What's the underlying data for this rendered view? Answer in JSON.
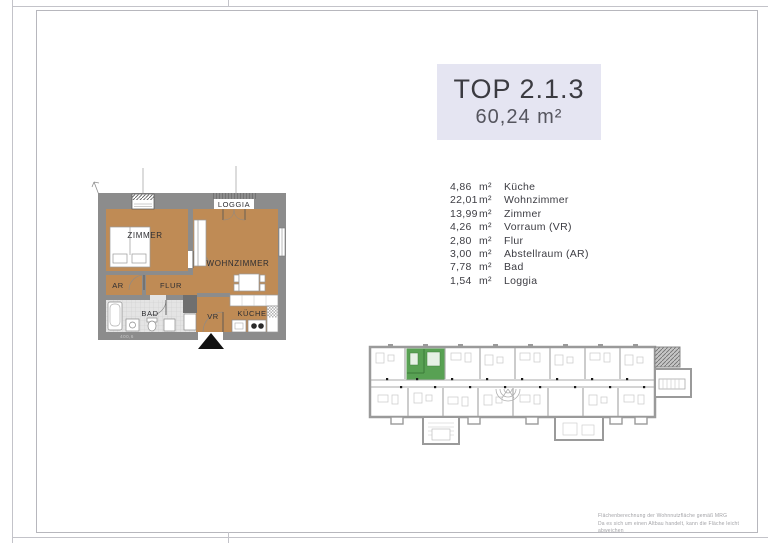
{
  "header": {
    "title": "TOP 2.1.3",
    "total_area": "60,24 m²"
  },
  "rooms": [
    {
      "area": "4,86",
      "unit": "m²",
      "name": "Küche"
    },
    {
      "area": "22,01",
      "unit": "m²",
      "name": "Wohnzimmer"
    },
    {
      "area": "13,99",
      "unit": "m²",
      "name": "Zimmer"
    },
    {
      "area": "4,26",
      "unit": "m²",
      "name": "Vorraum (VR)"
    },
    {
      "area": "2,80",
      "unit": "m²",
      "name": "Flur"
    },
    {
      "area": "3,00",
      "unit": "m²",
      "name": "Abstellraum (AR)"
    },
    {
      "area": "7,78",
      "unit": "m²",
      "name": "Bad"
    },
    {
      "area": "1,54",
      "unit": "m²",
      "name": "Loggia"
    }
  ],
  "floorplan": {
    "labels": {
      "zimmer": "ZIMMER",
      "wohnzimmer": "WOHNZIMMER",
      "loggia": "LOGGIA",
      "ar": "AR",
      "flur": "FLUR",
      "bad": "BAD",
      "vr": "VR",
      "kueche": "KÜCHE"
    },
    "dimension_note": "400,6"
  },
  "footer": {
    "disclaimer_line1": "Flächenberechnung der Wohnnutzfläche gemäß MRG",
    "disclaimer_line2": "Da es sich um einen Altbau handelt, kann die Fläche leicht abweichen"
  },
  "colors": {
    "title_box_bg": "#e5e5f2",
    "wood_floor": "#bf8b55",
    "wall_gray": "#8c8c8c",
    "bath_tile": "#e4e4e4",
    "highlight_green": "#58a153"
  }
}
